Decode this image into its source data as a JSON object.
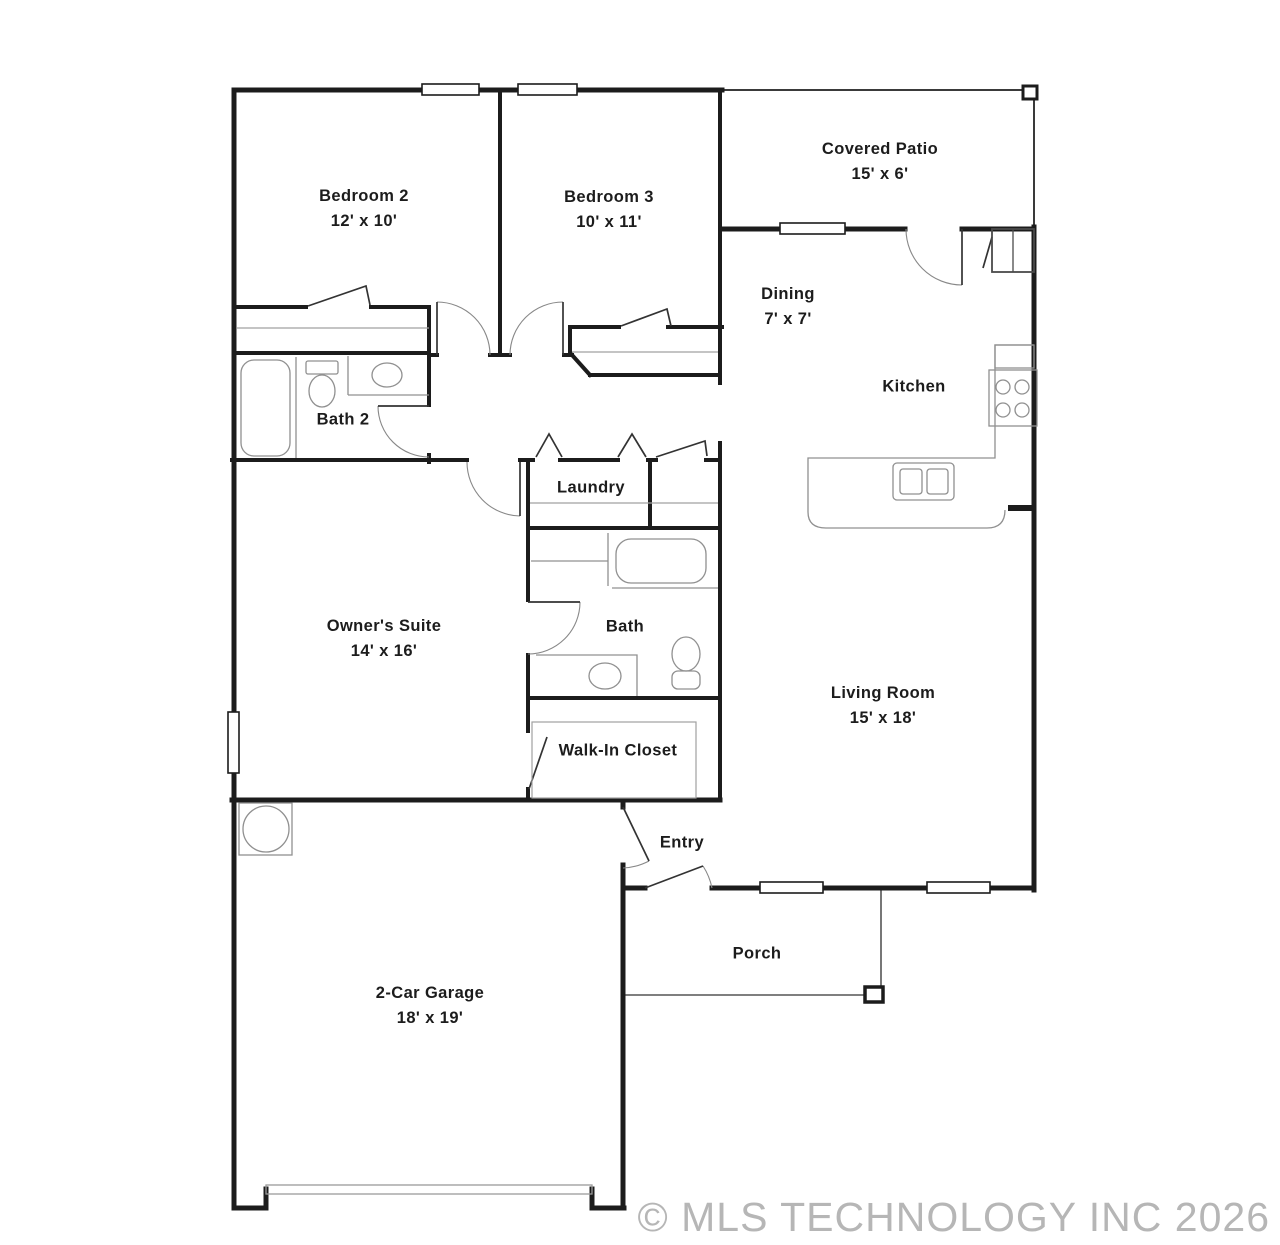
{
  "floorplan": {
    "rooms": [
      {
        "name": "Bedroom 2",
        "dims": "12' x 10'"
      },
      {
        "name": "Bedroom 3",
        "dims": "10' x 11'"
      },
      {
        "name": "Covered Patio",
        "dims": "15' x 6'"
      },
      {
        "name": "Dining",
        "dims": "7' x 7'"
      },
      {
        "name": "Kitchen",
        "dims": ""
      },
      {
        "name": "Bath 2",
        "dims": ""
      },
      {
        "name": "Laundry",
        "dims": ""
      },
      {
        "name": "Owner's Suite",
        "dims": "14' x 16'"
      },
      {
        "name": "Bath",
        "dims": ""
      },
      {
        "name": "Walk-In Closet",
        "dims": ""
      },
      {
        "name": "Living Room",
        "dims": "15' x 18'"
      },
      {
        "name": "Entry",
        "dims": ""
      },
      {
        "name": "Porch",
        "dims": ""
      },
      {
        "name": "2-Car Garage",
        "dims": "18' x 19'"
      }
    ],
    "watermark": "© MLS TECHNOLOGY INC 2026",
    "colors": {
      "wall": "#1c1c1c",
      "fixture": "#909090",
      "door": "#333333",
      "arc": "#888888",
      "label": "#1c1c1c",
      "watermark": "#b6b6b6",
      "background": "#ffffff"
    }
  }
}
